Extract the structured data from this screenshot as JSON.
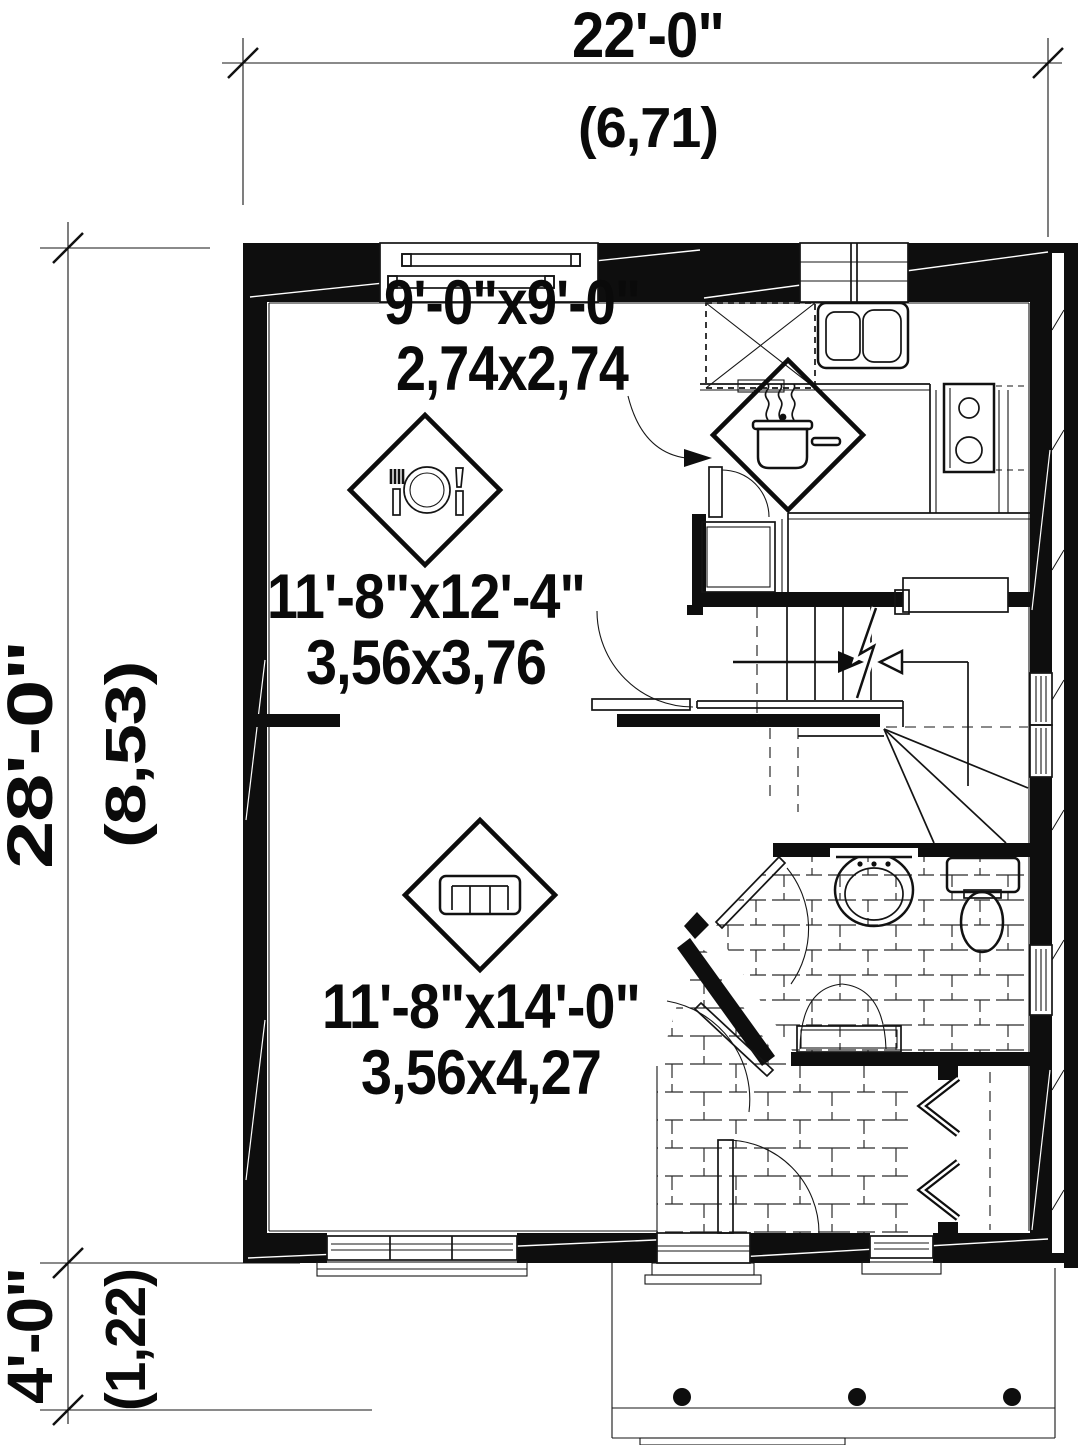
{
  "drawing": {
    "type": "floor-plan",
    "ink_color": "#0e0e0e",
    "background_color": "#ffffff"
  },
  "dimensions": {
    "top": {
      "imperial": "22'-0\"",
      "metric": "(6,71)"
    },
    "left_main": {
      "imperial": "28'-0\"",
      "metric": "(8,53)"
    },
    "left_porch": {
      "imperial": "4'-0\"",
      "metric": "(1,22)"
    }
  },
  "rooms": {
    "kitchen": {
      "imperial": "9'-0\"x9'-0\"",
      "metric": "2,74x2,74"
    },
    "dining": {
      "imperial": "11'-8\"x12'-4\"",
      "metric": "3,56x3,76"
    },
    "living": {
      "imperial": "11'-8\"x14'-0\"",
      "metric": "3,56x4,27"
    }
  },
  "icons": {
    "kitchen_marker": "cooking-pot-icon",
    "dining_marker": "place-setting-icon",
    "living_marker": "sofa-icon",
    "stair_direction": "stair-arrows-icon"
  }
}
